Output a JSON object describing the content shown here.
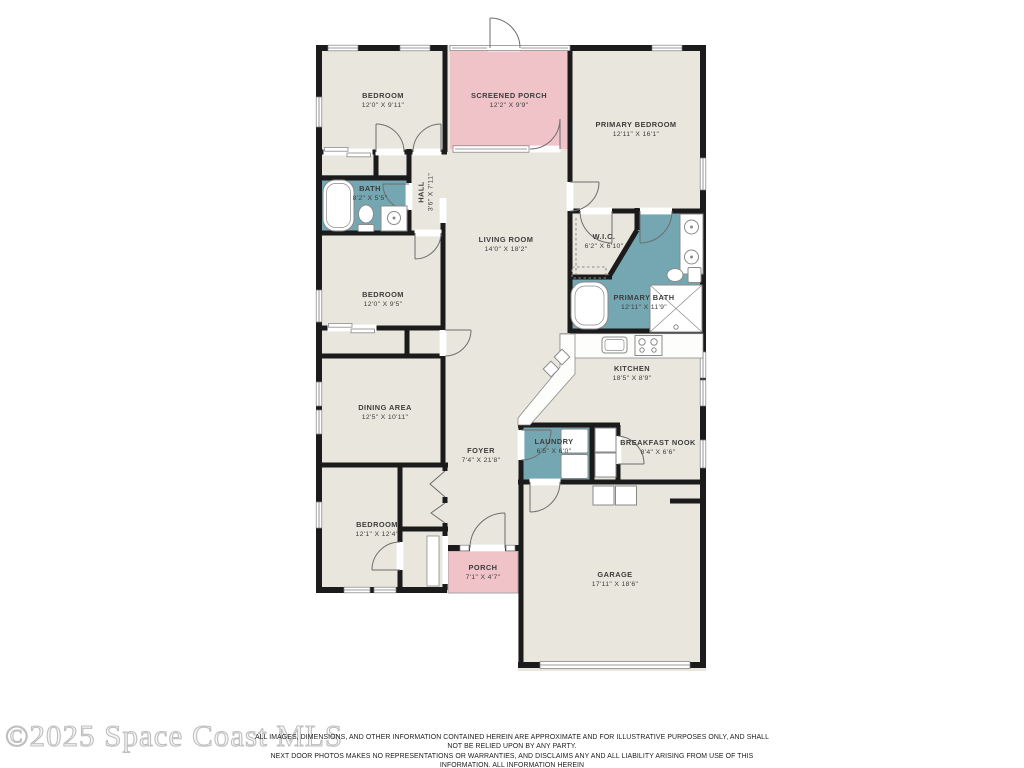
{
  "watermark": "©2025 Space Coast MLS",
  "disclaimer": {
    "line1": "ALL IMAGES, DIMENSIONS, AND OTHER INFORMATION CONTAINED HEREIN ARE APPROXIMATE AND FOR ILLUSTRATIVE PURPOSES ONLY, AND SHALL NOT BE RELIED UPON BY ANY PARTY.",
    "line2": "NEXT DOOR PHOTOS MAKES NO REPRESENTATIONS OR WARRANTIES, AND DISCLAIMS ANY AND ALL LIABILITY ARISING FROM USE OF THIS INFORMATION. ALL INFORMATION HEREIN",
    "line3": "SHALL BE SUBJECT TO THE TERMS AND CONDITIONS FOUND AT NEXTDOORPHOTOS.COM/TC."
  },
  "palette": {
    "floor": "#e8e6dd",
    "porch": "#f0c3c8",
    "wet_room": "#74a7b2",
    "wall": "#1b1b1b"
  },
  "rooms": [
    {
      "id": "bedroom-top",
      "name": "BEDROOM",
      "dims": "12'0\" X 9'11\""
    },
    {
      "id": "screened-porch",
      "name": "SCREENED PORCH",
      "dims": "12'2\" X 9'9\""
    },
    {
      "id": "primary-bedroom",
      "name": "PRIMARY BEDROOM",
      "dims": "12'11\" X 16'1\""
    },
    {
      "id": "bath",
      "name": "BATH",
      "dims": "8'2\" X 5'5\""
    },
    {
      "id": "hall",
      "name": "HALL",
      "dims": "3'6\" X 7'11\""
    },
    {
      "id": "living-room",
      "name": "LIVING ROOM",
      "dims": "14'0\" X 18'2\""
    },
    {
      "id": "wic",
      "name": "W.I.C.",
      "dims": "6'2\" X 6'10\""
    },
    {
      "id": "bedroom-middle",
      "name": "BEDROOM",
      "dims": "12'0\" X 9'5\""
    },
    {
      "id": "primary-bath",
      "name": "PRIMARY BATH",
      "dims": "12'11\" X 11'9\""
    },
    {
      "id": "kitchen",
      "name": "KITCHEN",
      "dims": "18'5\" X 8'9\""
    },
    {
      "id": "dining-area",
      "name": "DINING AREA",
      "dims": "12'5\" X 10'11\""
    },
    {
      "id": "foyer",
      "name": "FOYER",
      "dims": "7'4\" X 21'8\""
    },
    {
      "id": "laundry",
      "name": "LAUNDRY",
      "dims": "6'5\" X 6'0\""
    },
    {
      "id": "breakfast-nook",
      "name": "BREAKFAST NOOK",
      "dims": "8'4\" X 6'6\""
    },
    {
      "id": "bedroom-bottom",
      "name": "BEDROOM",
      "dims": "12'1\" X 12'4\""
    },
    {
      "id": "porch",
      "name": "PORCH",
      "dims": "7'1\" X 4'7\""
    },
    {
      "id": "garage",
      "name": "GARAGE",
      "dims": "17'11\" X 18'6\""
    }
  ]
}
